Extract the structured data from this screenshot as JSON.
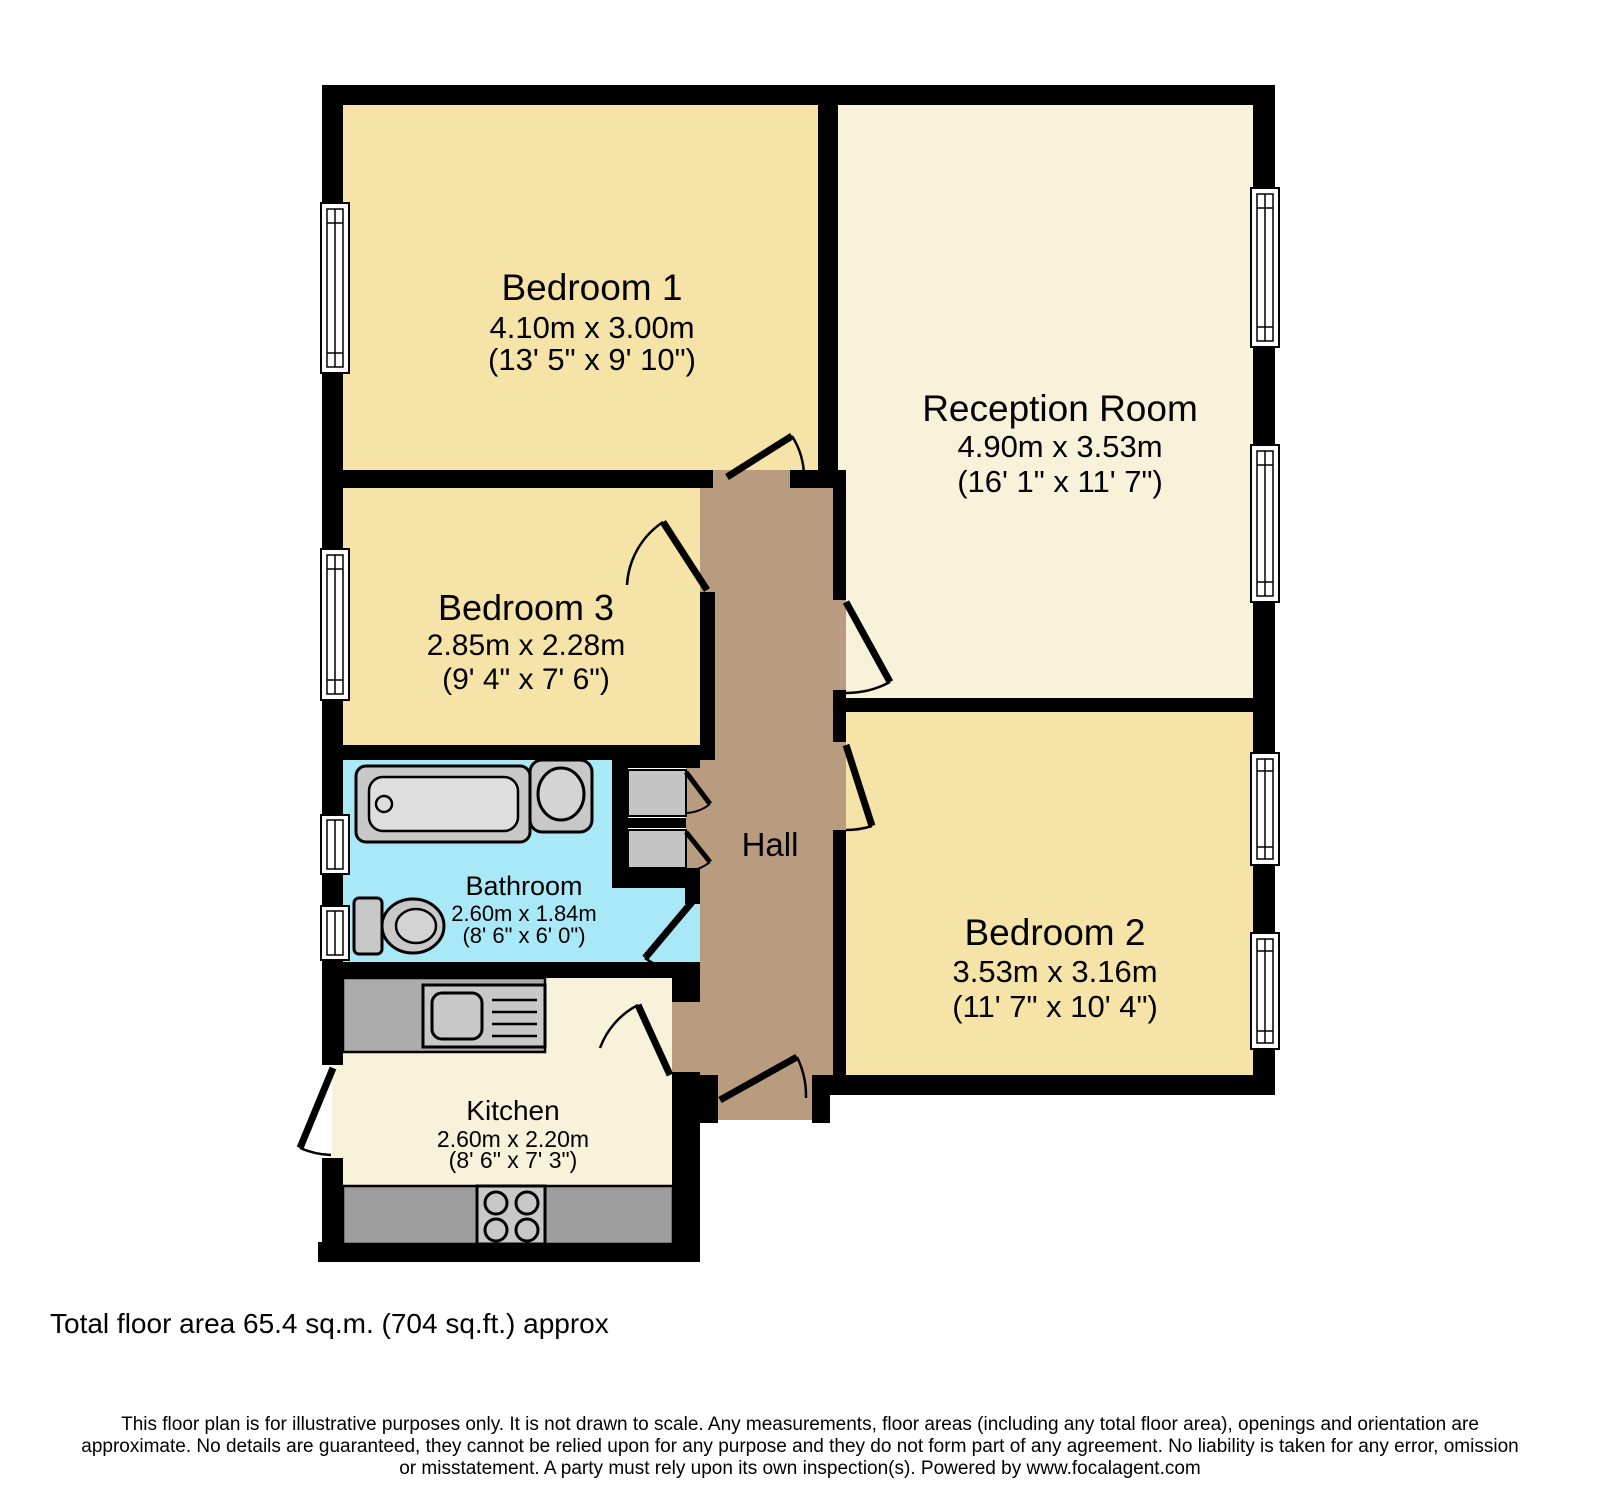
{
  "rooms": [
    {
      "name": "Bedroom 1",
      "metric": "4.10m x 3.00m",
      "imperial": "(13' 5\" x 9' 10\")"
    },
    {
      "name": "Reception Room",
      "metric": "4.90m x 3.53m",
      "imperial": "(16' 1\" x 11' 7\")"
    },
    {
      "name": "Bedroom 3",
      "metric": "2.85m x 2.28m",
      "imperial": "(9' 4\" x 7' 6\")"
    },
    {
      "name": "Hall"
    },
    {
      "name": "Bathroom",
      "metric": "2.60m x 1.84m",
      "imperial": "(8' 6\" x 6' 0\")"
    },
    {
      "name": "Bedroom 2",
      "metric": "3.53m x 3.16m",
      "imperial": "(11' 7\" x 10' 4\")"
    },
    {
      "name": "Kitchen",
      "metric": "2.60m x 2.20m",
      "imperial": "(8' 6\" x 7' 3\")"
    }
  ],
  "fixtures": [
    "bathtub",
    "basin",
    "toilet",
    "cupboards",
    "kitchen-sink",
    "hob"
  ],
  "footer": {
    "total_area": "Total floor area 65.4 sq.m. (704 sq.ft.) approx",
    "disclaimer_line1": "This floor plan is for illustrative purposes only. It is not drawn to scale. Any measurements, floor areas (including any total floor area), openings and orientation are",
    "disclaimer_line2": "approximate. No details are guaranteed, they cannot be relied upon for any purpose and they do not form part of any agreement. No liability is taken for any error, omission",
    "disclaimer_line3": "or misstatement. A party must rely upon its own inspection(s). Powered by www.focalagent.com"
  },
  "colors": {
    "wall": "#000000",
    "bedroom_fill": "#F6E3A7",
    "reception_kitchen_fill": "#F8F2DA",
    "hall_fill": "#B99C80",
    "bathroom_fill": "#A9E8F7",
    "fixture_gray": "#C8C8C8",
    "counter_gray": "#ACACAC",
    "counter_dark_gray": "#9E9E9E",
    "window_white": "#FFFFFF"
  }
}
